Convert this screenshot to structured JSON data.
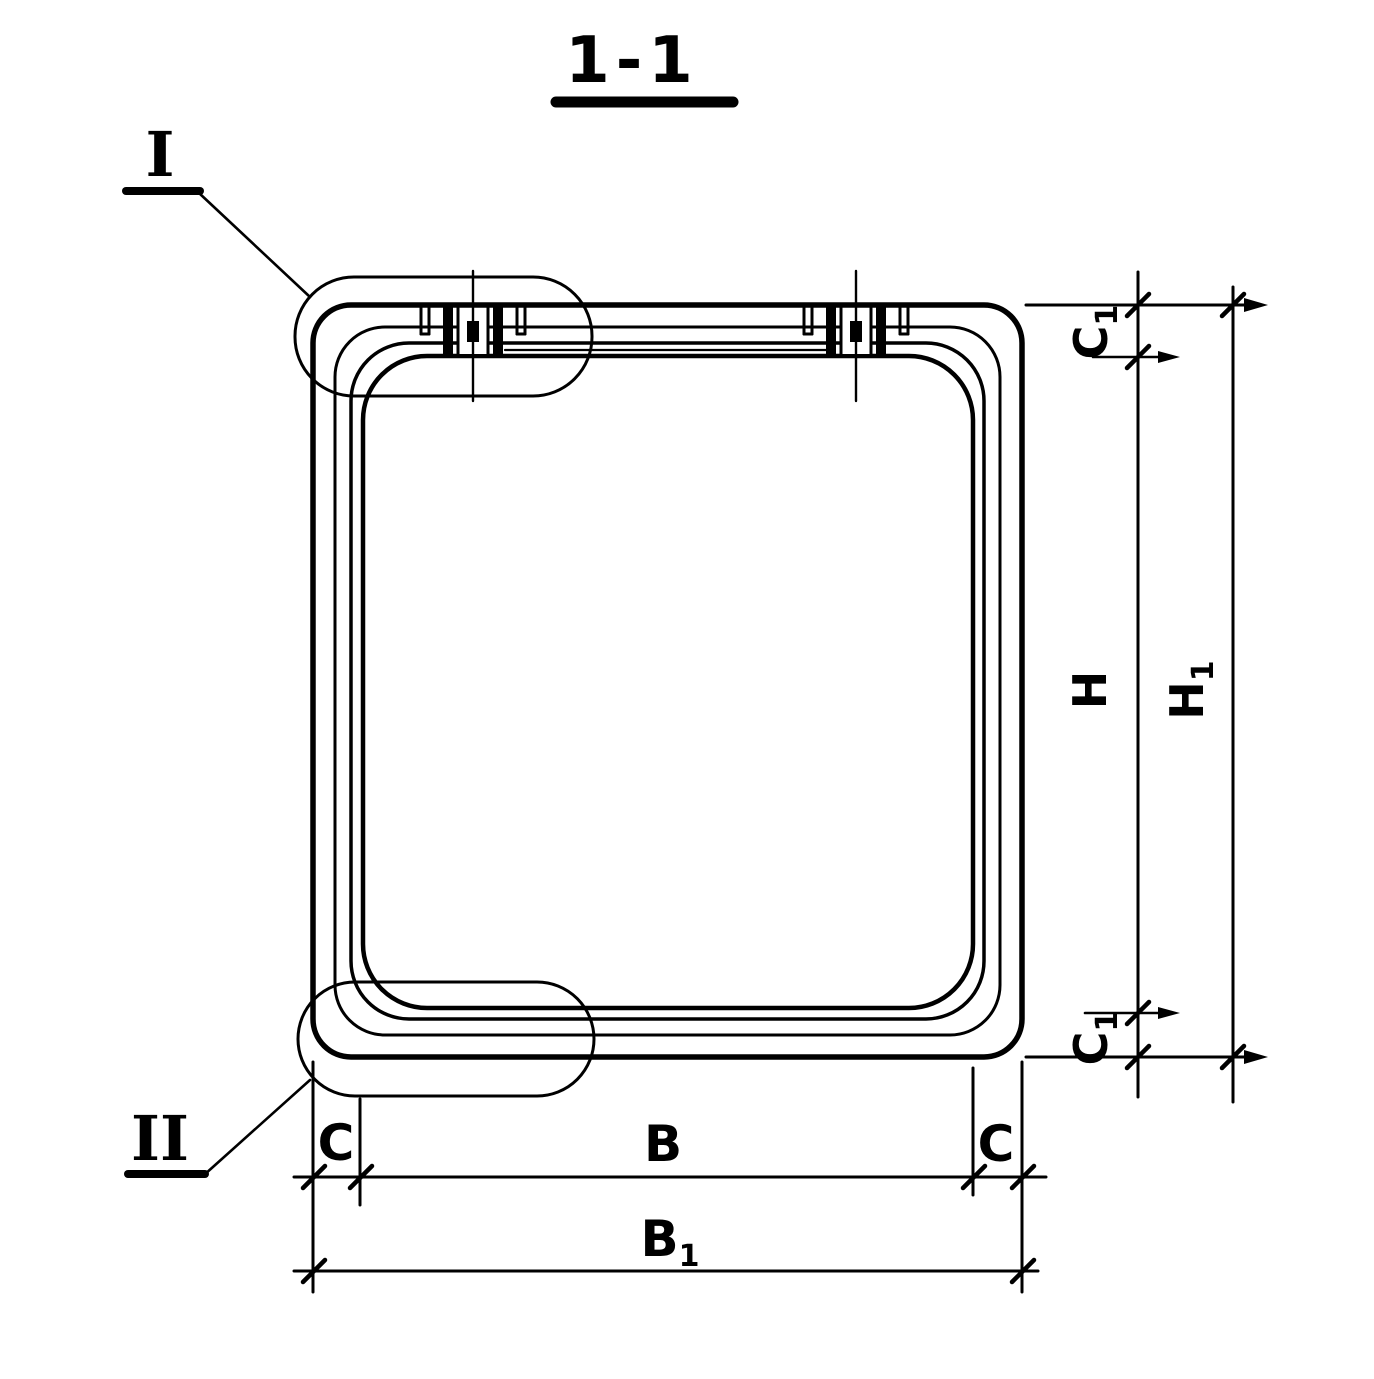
{
  "title": {
    "text": "1-1"
  },
  "colors": {
    "ink": "#000000",
    "paper": "#ffffff"
  },
  "details": {
    "one": {
      "label": "I"
    },
    "two": {
      "label": "II"
    }
  },
  "dims": {
    "c1_top": {
      "main": "C",
      "sub": "1"
    },
    "h": {
      "main": "H",
      "sub": ""
    },
    "h1": {
      "main": "H",
      "sub": "1"
    },
    "c1_bottom": {
      "main": "C",
      "sub": "1"
    },
    "c_left": {
      "main": "C",
      "sub": ""
    },
    "b": {
      "main": "B",
      "sub": ""
    },
    "c_right": {
      "main": "C",
      "sub": ""
    },
    "b1": {
      "main": "B",
      "sub": "1"
    }
  }
}
